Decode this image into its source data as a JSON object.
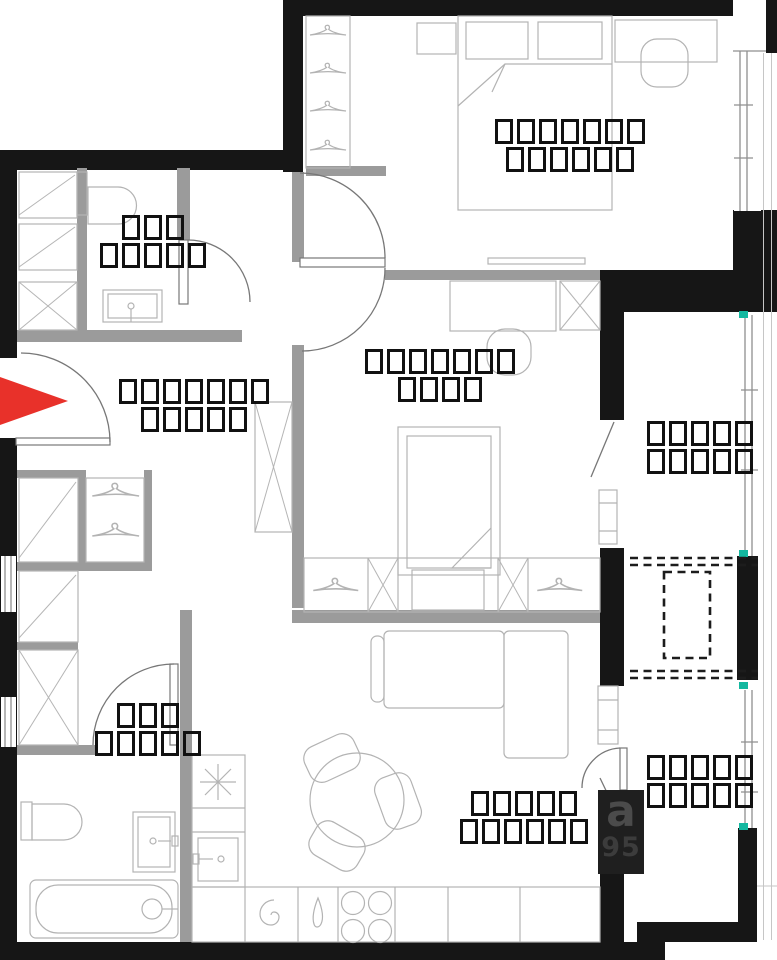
{
  "meta": {
    "kind": "apartment-floor-plan"
  },
  "colors": {
    "wall": "#161616",
    "partition": "#9b9b9b",
    "furniture": "#b3b3b3",
    "door": "#777777",
    "red": "#e8312a",
    "teal": "#14b8a0",
    "label_ink": "#111111",
    "watermark_bg": "#1f1f1f",
    "watermark_ink": "#4b4b4b"
  },
  "labels": {
    "bedroom_main": {
      "line1": "▯▯▯▯▯▯▯",
      "line2": "▯▯▯▯▯▯"
    },
    "bathroom_top": {
      "line1": "▯▯▯",
      "line2": "▯▯▯▯▯"
    },
    "hallway": {
      "line1": "▯▯▯▯▯▯▯",
      "line2": "▯▯▯▯▯"
    },
    "bedroom_second": {
      "line1": "▯▯▯▯▯▯▯",
      "line2": "▯▯▯▯"
    },
    "loggia_upper": {
      "line1": "▯▯▯▯▯",
      "line2": "▯▯▯▯▯"
    },
    "loggia_lower": {
      "line1": "▯▯▯▯▯",
      "line2": "▯▯▯▯▯"
    },
    "kitchen_living": {
      "line1": "▯▯▯▯▯",
      "line2": "▯▯▯▯▯▯"
    },
    "bathroom_bottom": {
      "line1": "▯▯▯",
      "line2": "▯▯▯▯▯"
    }
  },
  "watermark": {
    "line1": "a",
    "line2": "95"
  }
}
